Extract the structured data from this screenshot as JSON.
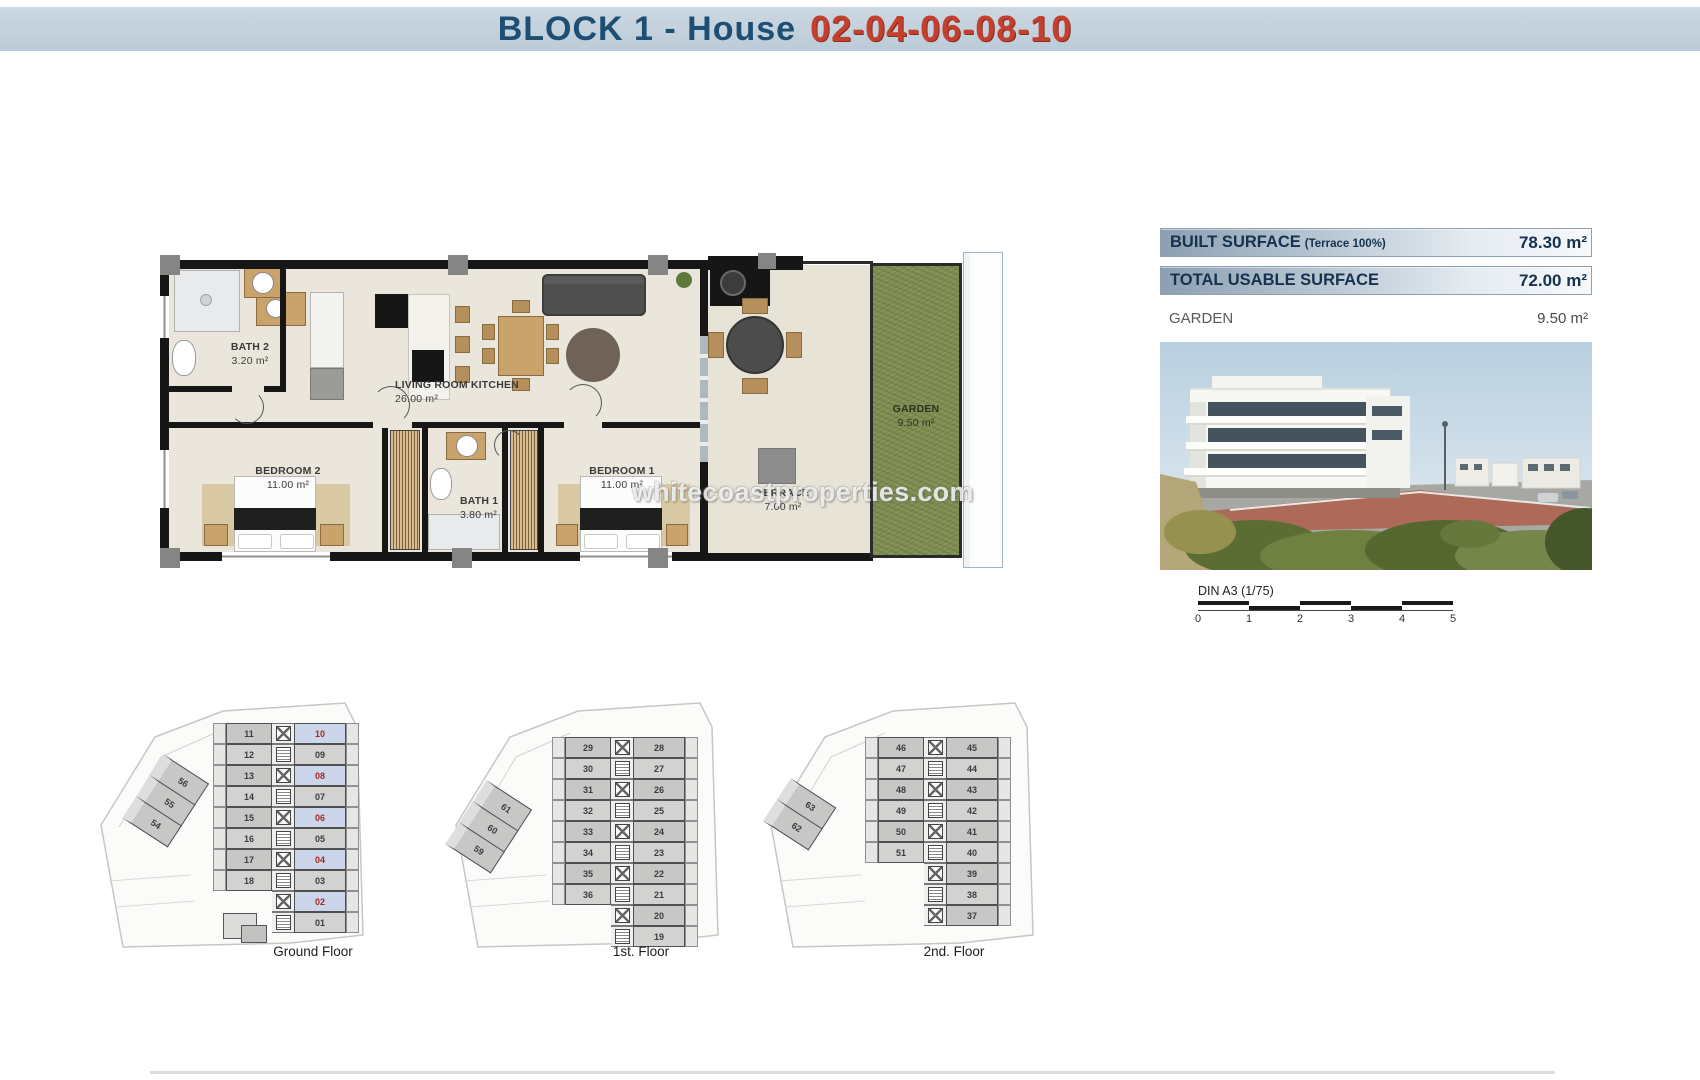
{
  "header": {
    "title_block": "BLOCK 1 - House",
    "title_numbers": "02-04-06-08-10"
  },
  "colors": {
    "title_blue": "#1d4e73",
    "title_red": "#c4402e",
    "header_bg": "#c3d1dd",
    "highlight_unit_bg": "#ccd6ea",
    "highlight_unit_text": "#a5281d",
    "garden_green": "#7e8d51"
  },
  "surface_table": {
    "rows": [
      {
        "label": "BUILT SURFACE",
        "note": "(Terrace 100%)",
        "value": "78.30 m²"
      },
      {
        "label": "TOTAL USABLE SURFACE",
        "note": "",
        "value": "72.00 m²"
      },
      {
        "label": "GARDEN",
        "note": "",
        "value": "9.50 m²"
      }
    ]
  },
  "floor_plan": {
    "rooms": [
      {
        "name": "BATH 2",
        "area": "3.20 m²"
      },
      {
        "name": "LIVING ROOM KITCHEN",
        "area": "26.00 m²"
      },
      {
        "name": "BEDROOM 2",
        "area": "11.00 m²"
      },
      {
        "name": "BATH 1",
        "area": "3.80 m²"
      },
      {
        "name": "BEDROOM 1",
        "area": "11.00 m²"
      },
      {
        "name": "TERRACE",
        "area": "7.00 m²"
      },
      {
        "name": "GARDEN",
        "area": "9.50 m²"
      }
    ]
  },
  "watermark": "whitecoastproperties.com",
  "scale_bar": {
    "label": "DIN A3 (1/75)",
    "ticks": [
      "0",
      "1",
      "2",
      "3",
      "4",
      "5"
    ]
  },
  "floors": [
    {
      "label": "Ground Floor",
      "rows": [
        [
          "11",
          "10"
        ],
        [
          "12",
          "09"
        ],
        [
          "13",
          "08"
        ],
        [
          "14",
          "07"
        ],
        [
          "15",
          "06"
        ],
        [
          "16",
          "05"
        ],
        [
          "17",
          "04"
        ],
        [
          "18",
          "03"
        ],
        [
          "",
          "02"
        ],
        [
          "",
          "01"
        ]
      ],
      "diagonal": [
        "56",
        "55",
        "54"
      ],
      "highlighted": [
        "10",
        "08",
        "06",
        "04",
        "02"
      ]
    },
    {
      "label": "1st. Floor",
      "rows": [
        [
          "29",
          "28"
        ],
        [
          "30",
          "27"
        ],
        [
          "31",
          "26"
        ],
        [
          "32",
          "25"
        ],
        [
          "33",
          "24"
        ],
        [
          "34",
          "23"
        ],
        [
          "35",
          "22"
        ],
        [
          "36",
          "21"
        ],
        [
          "",
          "20"
        ],
        [
          "",
          "19"
        ]
      ],
      "diagonal": [
        "61",
        "60",
        "59"
      ],
      "highlighted": []
    },
    {
      "label": "2nd. Floor",
      "rows": [
        [
          "46",
          "45"
        ],
        [
          "47",
          "44"
        ],
        [
          "48",
          "43"
        ],
        [
          "49",
          "42"
        ],
        [
          "50",
          "41"
        ],
        [
          "51",
          "40"
        ],
        [
          "",
          "39"
        ],
        [
          "",
          "38"
        ],
        [
          "",
          "37"
        ]
      ],
      "diagonal": [
        "63",
        "62"
      ],
      "highlighted": []
    }
  ]
}
